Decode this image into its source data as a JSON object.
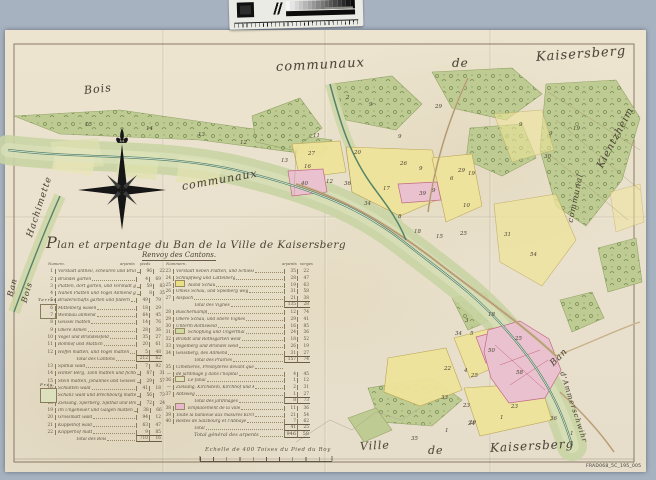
{
  "scan": {
    "background_color": "#a7b2c0",
    "paper_color": "#ece4cf",
    "reference_label": "FRAD068_5C_195_005"
  },
  "calibration": {
    "name": "grayscale-step-wedge-target",
    "steps": 16
  },
  "map": {
    "labels": [
      {
        "text": "communaux",
        "x": 276,
        "y": 60,
        "size": 13,
        "rot": -3
      },
      {
        "text": "de",
        "x": 452,
        "y": 56,
        "size": 12,
        "rot": 0
      },
      {
        "text": "Kaisersberg",
        "x": 536,
        "y": 50,
        "size": 13,
        "rot": -4
      },
      {
        "text": "Bois",
        "x": 84,
        "y": 84,
        "size": 11,
        "rot": -6
      },
      {
        "text": "Hachimette",
        "x": 30,
        "y": 232,
        "size": 9,
        "rot": -72
      },
      {
        "text": "communaux",
        "x": 182,
        "y": 180,
        "size": 11,
        "rot": -10
      },
      {
        "text": "Kientzheim",
        "x": 600,
        "y": 162,
        "size": 10,
        "rot": -62
      },
      {
        "text": "communal",
        "x": 570,
        "y": 218,
        "size": 8,
        "rot": -78
      },
      {
        "text": "Ban",
        "x": 552,
        "y": 360,
        "size": 9,
        "rot": -45
      },
      {
        "text": "d'Ammerschwihr",
        "x": 562,
        "y": 368,
        "size": 7,
        "rot": 72
      },
      {
        "text": "Ville",
        "x": 360,
        "y": 440,
        "size": 11,
        "rot": -3
      },
      {
        "text": "de",
        "x": 428,
        "y": 444,
        "size": 11,
        "rot": 0
      },
      {
        "text": "Kaisersberg",
        "x": 490,
        "y": 441,
        "size": 12,
        "rot": -3
      },
      {
        "text": "Ban",
        "x": 10,
        "y": 292,
        "size": 8,
        "rot": -76
      },
      {
        "text": "Bois",
        "x": 24,
        "y": 298,
        "size": 8,
        "rot": -74
      },
      {
        "text": "Terres.",
        "x": 38,
        "y": 297,
        "size": 4,
        "rot": 0
      },
      {
        "text": "Prés.",
        "x": 40,
        "y": 382,
        "size": 4,
        "rot": 0
      }
    ],
    "parcels": [
      {
        "n": "15",
        "x": 85,
        "y": 122
      },
      {
        "n": "14",
        "x": 146,
        "y": 126
      },
      {
        "n": "13",
        "x": 198,
        "y": 132
      },
      {
        "n": "12",
        "x": 240,
        "y": 140
      },
      {
        "n": "13",
        "x": 281,
        "y": 158
      },
      {
        "n": "11",
        "x": 313,
        "y": 133
      },
      {
        "n": "27",
        "x": 308,
        "y": 151
      },
      {
        "n": "20",
        "x": 354,
        "y": 150
      },
      {
        "n": "16",
        "x": 304,
        "y": 164
      },
      {
        "n": "40",
        "x": 301,
        "y": 181
      },
      {
        "n": "12",
        "x": 326,
        "y": 179
      },
      {
        "n": "36",
        "x": 344,
        "y": 181
      },
      {
        "n": "26",
        "x": 400,
        "y": 161
      },
      {
        "n": "17",
        "x": 383,
        "y": 186
      },
      {
        "n": "39",
        "x": 419,
        "y": 191
      },
      {
        "n": "9",
        "x": 398,
        "y": 134
      },
      {
        "n": "9",
        "x": 419,
        "y": 166
      },
      {
        "n": "9",
        "x": 432,
        "y": 188
      },
      {
        "n": "29",
        "x": 435,
        "y": 104
      },
      {
        "n": "29",
        "x": 458,
        "y": 168
      },
      {
        "n": "2",
        "x": 346,
        "y": 95
      },
      {
        "n": "9",
        "x": 369,
        "y": 102
      },
      {
        "n": "19",
        "x": 468,
        "y": 171
      },
      {
        "n": "6",
        "x": 450,
        "y": 176
      },
      {
        "n": "10",
        "x": 463,
        "y": 203
      },
      {
        "n": "34",
        "x": 364,
        "y": 201
      },
      {
        "n": "8",
        "x": 398,
        "y": 214
      },
      {
        "n": "18",
        "x": 414,
        "y": 229
      },
      {
        "n": "15",
        "x": 436,
        "y": 234
      },
      {
        "n": "25",
        "x": 460,
        "y": 231
      },
      {
        "n": "30",
        "x": 544,
        "y": 154
      },
      {
        "n": "9",
        "x": 519,
        "y": 122
      },
      {
        "n": "9",
        "x": 549,
        "y": 131
      },
      {
        "n": "19",
        "x": 573,
        "y": 126
      },
      {
        "n": "54",
        "x": 530,
        "y": 252
      },
      {
        "n": "31",
        "x": 504,
        "y": 232
      },
      {
        "n": "18",
        "x": 488,
        "y": 312
      },
      {
        "n": "5",
        "x": 470,
        "y": 331
      },
      {
        "n": "34",
        "x": 455,
        "y": 331
      },
      {
        "n": "3",
        "x": 465,
        "y": 318
      },
      {
        "n": "22",
        "x": 444,
        "y": 366
      },
      {
        "n": "4",
        "x": 464,
        "y": 368
      },
      {
        "n": "25",
        "x": 471,
        "y": 373
      },
      {
        "n": "33",
        "x": 441,
        "y": 395
      },
      {
        "n": "23",
        "x": 463,
        "y": 403
      },
      {
        "n": "24",
        "x": 468,
        "y": 421
      },
      {
        "n": "35",
        "x": 411,
        "y": 436
      },
      {
        "n": "1",
        "x": 445,
        "y": 428
      },
      {
        "n": "1",
        "x": 500,
        "y": 415
      },
      {
        "n": "1",
        "x": 570,
        "y": 431
      },
      {
        "n": "29",
        "x": 469,
        "y": 420
      },
      {
        "n": "50",
        "x": 488,
        "y": 348
      },
      {
        "n": "58",
        "x": 516,
        "y": 370
      },
      {
        "n": "25",
        "x": 515,
        "y": 336
      },
      {
        "n": "23",
        "x": 511,
        "y": 404
      },
      {
        "n": "36",
        "x": 550,
        "y": 416
      }
    ]
  },
  "cartouche": {
    "title": "Plan et arpentage du Ban de la Ville de Kaisersberg",
    "subtitle": "Renvoy des Cantons.",
    "left_headers": {
      "num": "Numero.",
      "a": "arpents",
      "p": "pieds"
    },
    "right_headers": {
      "num": "Nummern.",
      "a": "arpents",
      "p": "verges"
    },
    "left_rows": [
      {
        "n": "1",
        "label": "Vorstadt antheil, scheuren und Bründel gärten",
        "a": "96",
        "p": "22"
      },
      {
        "n": "2",
        "label": "Bründel gärten",
        "a": "4",
        "p": "69"
      },
      {
        "n": "3",
        "label": "Platten, dort gärten, und Vorstadt gärten",
        "a": "59",
        "p": "83"
      },
      {
        "n": "4",
        "label": "Nahen Platten und Vogel Allmend gärten",
        "a": "8",
        "p": "35"
      },
      {
        "n": "5",
        "label": "Bruderschafts gärten und fildern",
        "a": "49",
        "p": "79"
      },
      {
        "n": "6",
        "label": "Mittelberg wasen",
        "a": "18",
        "p": "29"
      },
      {
        "n": "7",
        "label": "Weinbau allmend",
        "a": "64",
        "p": "45"
      },
      {
        "n": "8",
        "label": "Geissel matten",
        "a": "14",
        "p": "76"
      },
      {
        "n": "9",
        "label": "Obere Almen",
        "a": "28",
        "p": "36"
      },
      {
        "n": "10",
        "label": "Vogel und Bründelsfeld",
        "a": "35",
        "p": "27"
      },
      {
        "n": "11",
        "label": "Bomhof und Mattich",
        "a": "20",
        "p": "61"
      },
      {
        "n": "12",
        "label": "Hoffel matten, und Vogel matten",
        "a": "5",
        "p": "48"
      },
      {
        "type": "total",
        "label": "Total des Cantons",
        "a": "212",
        "p": "62"
      },
      {
        "n": "13",
        "label": "Spithal wald",
        "a": "7",
        "p": "92"
      },
      {
        "n": "14",
        "label": "Hinter Berg, Tann matten und fichten wald",
        "a": "87",
        "p": "31"
      },
      {
        "n": "15",
        "label": "Stein matten, Johannes und Geissel wald",
        "a": "29",
        "p": "57"
      },
      {
        "n": "16",
        "label": "Schlatten wald",
        "a": "41",
        "p": "18"
      },
      {
        "n": "17",
        "label": "Schanz wald und Brechbourg matten",
        "a": "56",
        "p": "73"
      },
      {
        "n": "18",
        "label": "Zielsang, Sperberg, Spithal und Brechbourg",
        "a": "72",
        "p": "24"
      },
      {
        "n": "19",
        "label": "Im Ungeheuer und Galgen matten",
        "a": "38",
        "p": "66"
      },
      {
        "n": "20",
        "label": "Grossmatt wald",
        "a": "94",
        "p": "12"
      },
      {
        "n": "21",
        "label": "Kuppelhof wald",
        "a": "63",
        "p": "47"
      },
      {
        "n": "22",
        "label": "Klipperhof matt",
        "a": "9",
        "p": "85"
      },
      {
        "type": "total",
        "label": "Total des Bois",
        "a": "710",
        "p": "16"
      }
    ],
    "right_rows": [
      {
        "n": "23",
        "label": "Vorstadt neben Platten, und Schiessberg",
        "a": "35",
        "p": "22"
      },
      {
        "n": "24",
        "label": "Schlüpfweg und Lattelberg",
        "a": "28",
        "p": "47"
      },
      {
        "n": "25",
        "label": "Aland Schau",
        "a": "19",
        "p": "63",
        "swatch": "#e9e083"
      },
      {
        "n": "26",
        "label": "Omeis Schau, und Spielberg weg",
        "a": "31",
        "p": "58"
      },
      {
        "n": "27",
        "label": "Alspach",
        "a": "21",
        "p": "38"
      },
      {
        "type": "total",
        "label": "Total des Vignes",
        "a": "135",
        "p": "28"
      },
      {
        "n": "28",
        "label": "Buscherkampf",
        "a": "12",
        "p": "74"
      },
      {
        "n": "29",
        "label": "Obere Schau, und obere Vignes",
        "a": "29",
        "p": "41"
      },
      {
        "n": "30",
        "label": "Unterm Rothsweid",
        "a": "16",
        "p": "85"
      },
      {
        "n": "31",
        "label": "Schöpfung und Ungerthal",
        "a": "24",
        "p": "36",
        "swatch": "#cfd9a0"
      },
      {
        "n": "32",
        "label": "Brandt und Rothsgarten weid",
        "a": "18",
        "p": "52"
      },
      {
        "n": "33",
        "label": "Vogelberg und Bründel weid",
        "a": "26",
        "p": "19"
      },
      {
        "n": "34",
        "label": "Geissberg, des Allmend",
        "a": "31",
        "p": "27"
      },
      {
        "type": "total",
        "label": "Total des Prairies",
        "a": "157",
        "p": "74"
      },
      {
        "n": "35",
        "label": "Cimetieres, Presbyteres devant que",
        "a": "",
        "p": ""
      },
      {
        "n": "—",
        "label": "de jardinage y dans l'hopital",
        "a": "4",
        "p": "45"
      },
      {
        "n": "36",
        "label": "Le fanal",
        "a": "1",
        "p": "12",
        "swatch": "#dfe0b8"
      },
      {
        "n": "—",
        "label": "Zielsang, Kirchstein, Kirchhof und Kirch",
        "a": "2",
        "p": "31"
      },
      {
        "n": "37",
        "label": "Abtsweg",
        "a": "1",
        "p": "27"
      },
      {
        "type": "total",
        "label": "Total des jardinages",
        "a": "8",
        "p": "73"
      },
      {
        "n": "38",
        "label": "Emplacement de la ville",
        "a": "11",
        "p": "36",
        "swatch": "#e8b9ca"
      },
      {
        "n": "39",
        "label": "Toute la banlieue aux masures Kirchberg",
        "a": "21",
        "p": "54"
      },
      {
        "n": "40",
        "label": "Restes de Salzbourg et l'Abbaye",
        "a": "7",
        "p": "62"
      },
      {
        "type": "total",
        "label": "Total",
        "a": "41",
        "p": "25"
      },
      {
        "type": "grand",
        "label": "Total général des arpents",
        "a": "946",
        "p": "58"
      }
    ],
    "scale_text": "Echelle de 400 Toises du Pied du Roy"
  }
}
